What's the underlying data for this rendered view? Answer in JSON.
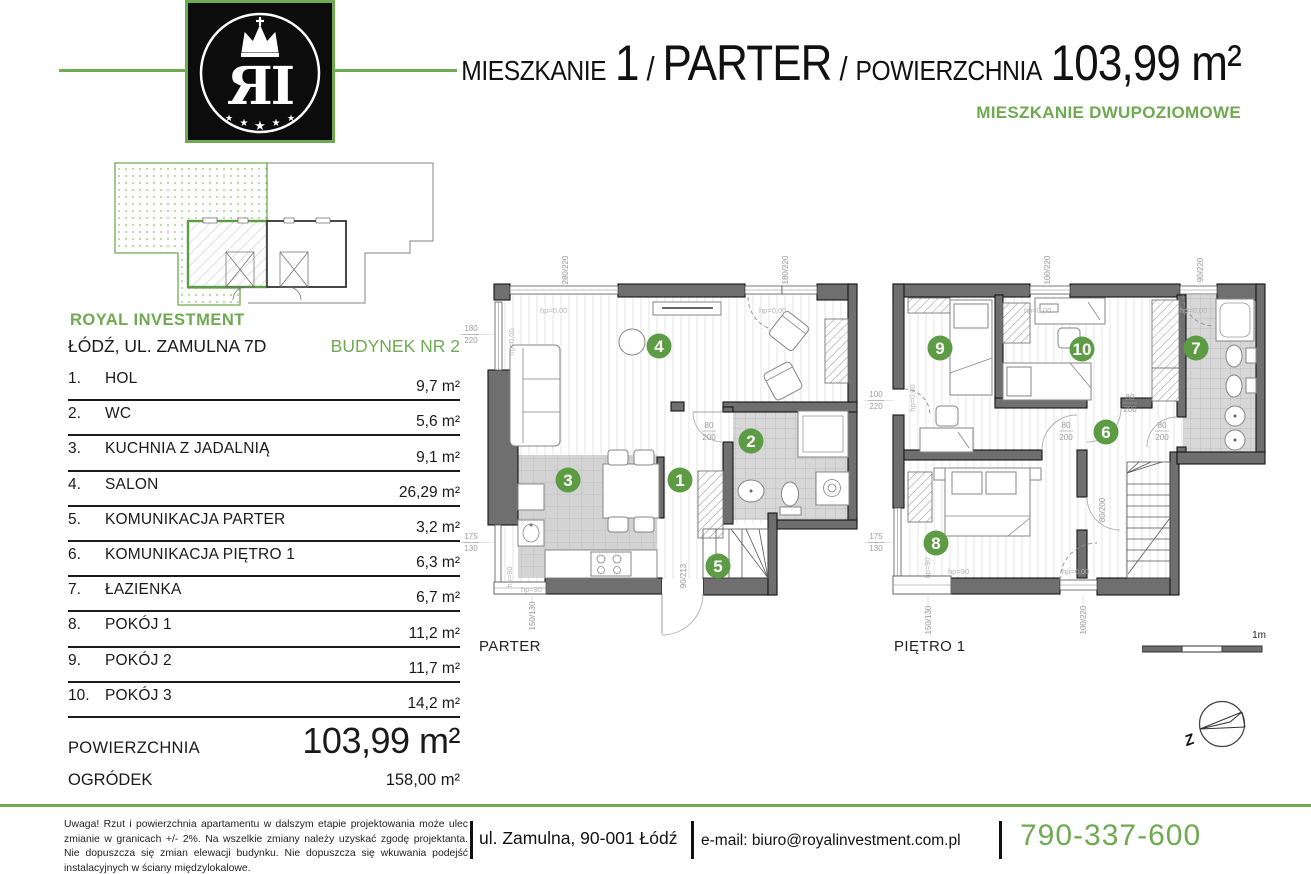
{
  "logo": {
    "letters": "ЯI",
    "star": "★"
  },
  "header": {
    "word1": "MIESZKANIE",
    "num": "1",
    "slash1": "/",
    "word2": "PARTER",
    "slash2": "/",
    "word3": "POWIERZCHNIA",
    "area": "103,99 m²",
    "subtitle": "MIESZKANIE DWUPOZIOMOWE"
  },
  "project": {
    "company": "ROYAL INVESTMENT",
    "address": "ŁÓDŹ, UL. ZAMULNA 7D",
    "building": "BUDYNEK NR 2"
  },
  "rooms": [
    {
      "no": "1.",
      "name": "HOL",
      "area": "9,7 m²"
    },
    {
      "no": "2.",
      "name": "WC",
      "area": "5,6 m²"
    },
    {
      "no": "3.",
      "name": "KUCHNIA Z JADALNIĄ",
      "area": "9,1 m²"
    },
    {
      "no": "4.",
      "name": "SALON",
      "area": "26,29 m²"
    },
    {
      "no": "5.",
      "name": "KOMUNIKACJA PARTER",
      "area": "3,2 m²"
    },
    {
      "no": "6.",
      "name": "KOMUNIKACJA PIĘTRO 1",
      "area": "6,3 m²"
    },
    {
      "no": "7.",
      "name": "ŁAZIENKA",
      "area": "6,7 m²"
    },
    {
      "no": "8.",
      "name": "POKÓJ 1",
      "area": "11,2 m²"
    },
    {
      "no": "9.",
      "name": "POKÓJ 2",
      "area": "11,7 m²"
    },
    {
      "no": "10.",
      "name": "POKÓJ 3",
      "area": "14,2 m²"
    }
  ],
  "totals": {
    "area_label": "POWIERZCHNIA",
    "area_value": "103,99 m²",
    "garden_label": "OGRÓDEK",
    "garden_value": "158,00 m²"
  },
  "plans": {
    "parter": {
      "label": "PARTER",
      "markers": {
        "m1": "1",
        "m2": "2",
        "m3": "3",
        "m4": "4",
        "m5": "5"
      },
      "dims": {
        "top1": "280/220",
        "top2": "180/220",
        "left1_top": "180",
        "left1_bot": "220",
        "left2_top": "175",
        "left2_bot": "130",
        "bottom1": "150/130",
        "entry": "90/213",
        "wc_top": "80",
        "wc_bot": "200"
      },
      "hp": {
        "a": "hp=0,00",
        "b": "hp=0,00",
        "c": "hp=0,00",
        "d": "hp=90",
        "e": "hp=90"
      }
    },
    "pietro": {
      "label": "PIĘTRO 1",
      "markers": {
        "m6": "6",
        "m7": "7",
        "m8": "8",
        "m9": "9",
        "m10": "10"
      },
      "dims": {
        "top1": "100/220",
        "top2": "90/220",
        "left1_top": "100",
        "left1_bot": "220",
        "left2_top": "175",
        "left2_bot": "130",
        "bottom1": "150/130",
        "bottom2": "100/220",
        "d1_top": "80",
        "d1_bot": "200",
        "d2_top": "80",
        "d2_bot": "200",
        "d3_top": "80",
        "d3_bot": "200",
        "d4": "80/200"
      },
      "hp": {
        "a": "hp=0,00",
        "b": "hp=0,00",
        "c": "hp=0,00",
        "d": "hp=90",
        "e": "hp=90",
        "f": "hp=0,00"
      }
    }
  },
  "legend": {
    "scale": "1m",
    "compass": "Z"
  },
  "footer": {
    "disclaimer": "Uwaga! Rzut i powierzchnia apartamentu w dalszym etapie projektowania może ulec zmianie w granicach +/- 2%. Na wszelkie zmiany należy uzyskać zgodę projektanta. Nie dopuszcza się zmian elewacji budynku. Nie dopuszcza się wkuwania podejść instalacyjnych w ściany międzylokalowe.",
    "address": "ul. Zamulna, 90-001 Łódź",
    "email": "e-mail: biuro@royalinvestment.com.pl",
    "phone": "790-337-600"
  },
  "colors": {
    "green_accent": "#6faa52",
    "green_circle": "#5d9b44",
    "wall_gray": "#6f6f6f",
    "tile_gray": "#d7d7d7"
  }
}
